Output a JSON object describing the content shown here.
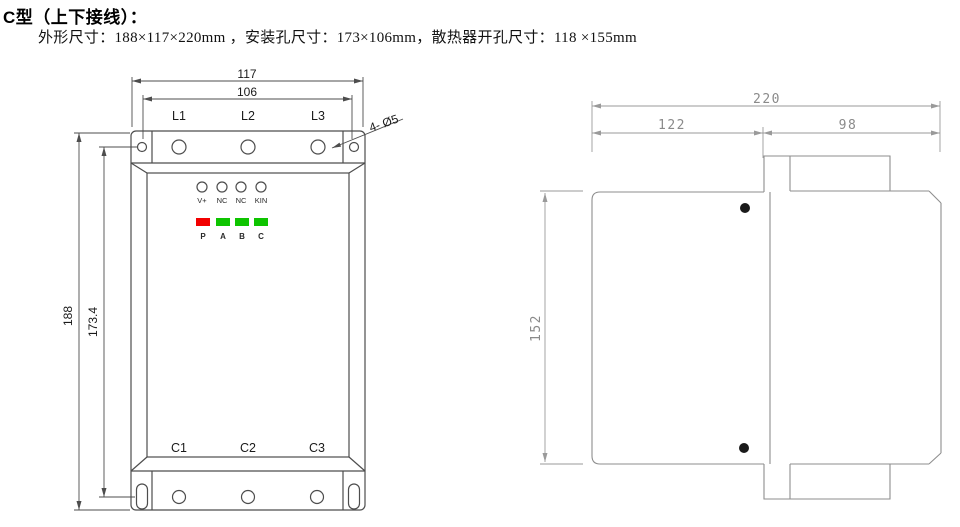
{
  "header": {
    "title": "C型（上下接线）：",
    "spec": "外形尺寸：188×117×220mm ，安装孔尺寸：173×106mm，散热器开孔尺寸：118 ×155mm"
  },
  "front_view": {
    "dim_width_outer": "117",
    "dim_width_holes": "106",
    "dim_height_outer": "188",
    "dim_height_holes": "173.4",
    "mount_hole_note": "4- Ø5",
    "input_terminals": [
      "L1",
      "L2",
      "L3"
    ],
    "output_terminals": [
      "C1",
      "C2",
      "C3"
    ],
    "control_terminals": [
      "V+",
      "NC",
      "NC",
      "KIN"
    ],
    "led_labels": [
      "P",
      "A",
      "B",
      "C"
    ],
    "led_colors": [
      "#f20000",
      "#0ec400",
      "#0ec400",
      "#0ec400"
    ]
  },
  "side_view": {
    "dim_depth_total": "220",
    "dim_depth_front": "122",
    "dim_depth_heatsink": "98",
    "dim_height_body": "152"
  },
  "colors": {
    "front_line": "#4d4d4d",
    "side_line": "#8e8e8e",
    "led_red": "#f20000",
    "led_green": "#0ec400"
  }
}
